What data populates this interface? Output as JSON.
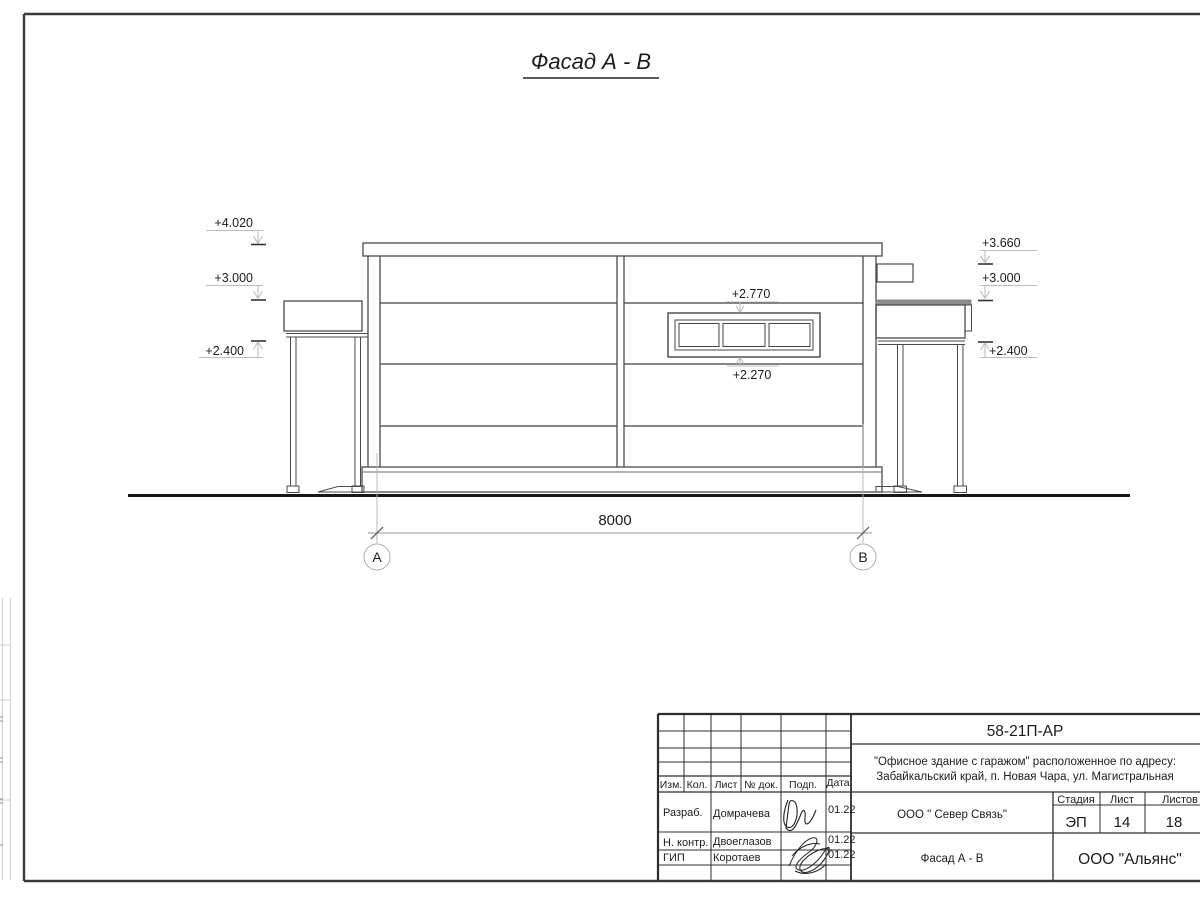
{
  "drawing": {
    "title": "Фасад А - В",
    "dim_8000": "8000",
    "axis_a": "А",
    "axis_b": "В",
    "elev_left_top": "+4.020",
    "elev_left_mid": "+3.000",
    "elev_left_low": "+2.400",
    "elev_right_top": "+3.660",
    "elev_right_mid": "+3.000",
    "elev_right_low": "+2.400",
    "window_top_mark": "+2.770",
    "window_bottom_mark": "+2.270"
  },
  "title_block": {
    "doc_number": "58-21П-АР",
    "project_line1": "\"Офисное здание с гаражом\" расположенное по адресу:",
    "project_line2": "Забайкальский край, п. Новая Чара, ул. Магистральная",
    "columns": [
      "Изм.",
      "Кол.",
      "Лист",
      "№ док.",
      "Подп.",
      "Дата"
    ],
    "rows": [
      {
        "role": "Разраб.",
        "name": "Домрачева",
        "date": "01.22"
      },
      {
        "role": "Н. контр.",
        "name": "Двоеглазов",
        "date": "01.22"
      },
      {
        "role": "ГИП",
        "name": "Коротаев",
        "date": "01.22"
      }
    ],
    "client": "ООО \" Север Связь\"",
    "stage_label": "Стадия",
    "sheet_label": "Лист",
    "sheets_label": "Листов",
    "stage_value": "ЭП",
    "sheet_value": "14",
    "sheets_value": "18",
    "sheet_title": "Фасад А - В",
    "company": "ООО \"Альянс\""
  }
}
